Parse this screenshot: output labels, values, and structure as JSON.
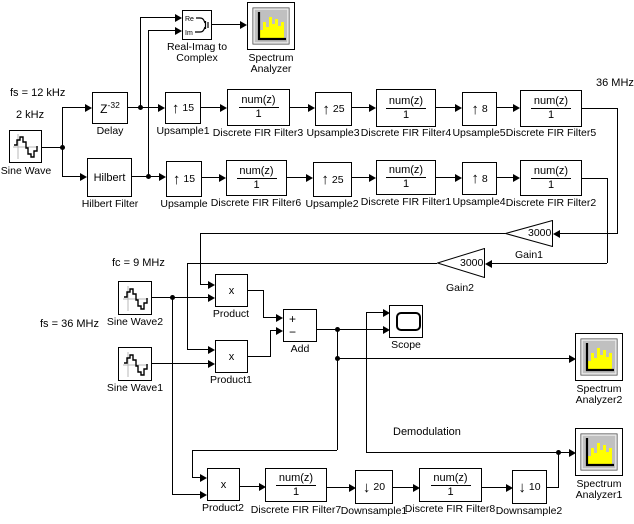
{
  "colors": {
    "line": "#000000",
    "background": "#ffffff",
    "icon_bg": "#c0c0c0",
    "spectrum_bars": "#ffff00"
  },
  "annotations": {
    "fs_12khz": "fs = 12 kHz",
    "two_khz": "2 kHz",
    "mhz_36": "36 MHz",
    "fc_9mhz": "fc = 9 MHz",
    "fs_36mhz": "fs = 36 MHz",
    "demodulation": "Demodulation"
  },
  "glyphs": {
    "up": "↑",
    "down": "↓",
    "plus": "+",
    "minus": "−",
    "times": "x",
    "re": "Re",
    "im": "Im"
  },
  "fir": {
    "num": "num(z)",
    "den": "1"
  },
  "blocks": {
    "sine_wave": {
      "label": "Sine Wave"
    },
    "sine_wave1": {
      "label": "Sine Wave1"
    },
    "sine_wave2": {
      "label": "Sine Wave2"
    },
    "delay": {
      "label": "Delay",
      "base": "Z",
      "exp": "-32"
    },
    "hilbert": {
      "label": "Hilbert Filter",
      "text": "Hilbert"
    },
    "upsample1": {
      "label": "Upsample1",
      "factor": "15"
    },
    "upsample": {
      "label": "Upsample",
      "factor": "15"
    },
    "upsample2": {
      "label": "Upsample2",
      "factor": "25"
    },
    "upsample3": {
      "label": "Upsample3",
      "factor": "25"
    },
    "upsample4": {
      "label": "Upsample4",
      "factor": "8"
    },
    "upsample5": {
      "label": "Upsample5",
      "factor": "8"
    },
    "fir1": {
      "label": "Discrete FIR Filter1"
    },
    "fir2": {
      "label": "Discrete FIR Filter2"
    },
    "fir3": {
      "label": "Discrete FIR Filter3"
    },
    "fir4": {
      "label": "Discrete FIR Filter4"
    },
    "fir5": {
      "label": "Discrete FIR Filter5"
    },
    "fir6": {
      "label": "Discrete FIR Filter6"
    },
    "fir7": {
      "label": "Discrete FIR Filter7"
    },
    "fir8": {
      "label": "Discrete FIR Filter8"
    },
    "downsample1": {
      "label": "Downsample1",
      "factor": "20"
    },
    "downsample2": {
      "label": "Downsample2",
      "factor": "10"
    },
    "gain1": {
      "label": "Gain1",
      "value": "3000"
    },
    "gain2": {
      "label": "Gain2",
      "value": "3000"
    },
    "product": {
      "label": "Product"
    },
    "product1": {
      "label": "Product1"
    },
    "product2": {
      "label": "Product2"
    },
    "add": {
      "label": "Add"
    },
    "scope": {
      "label": "Scope"
    },
    "reimag": {
      "label1": "Real-Imag to",
      "label2": "Complex"
    },
    "spectrum": {
      "label1": "Spectrum",
      "label2": "Analyzer"
    },
    "spectrum1": {
      "label1": "Spectrum",
      "label2": "Analyzer1"
    },
    "spectrum2": {
      "label1": "Spectrum",
      "label2": "Analyzer2"
    }
  }
}
